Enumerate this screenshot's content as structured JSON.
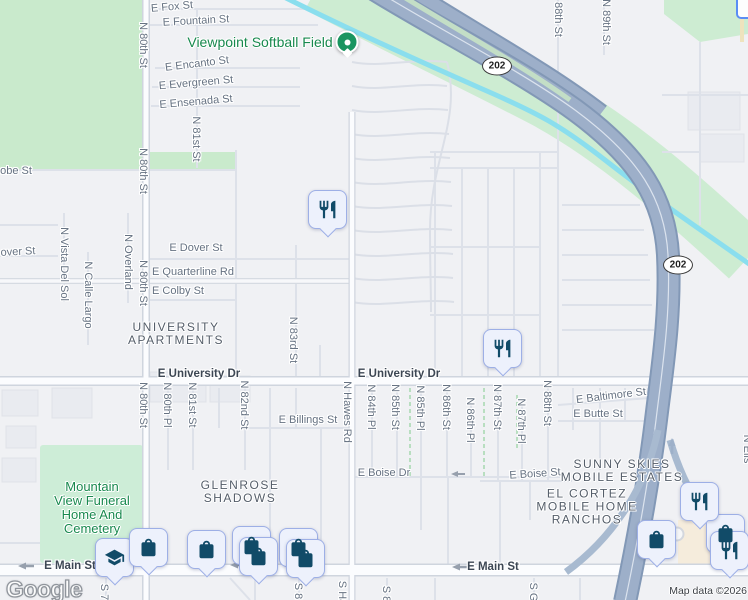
{
  "map": {
    "watermark": "Google",
    "attribution": "Map data ©2026",
    "colors": {
      "background": "#f0f1f4",
      "park_green": "#c9eacc",
      "greenway": "#cdecd2",
      "canal_cyan": "#8adeee",
      "freeway_fill": "#9dafc9",
      "pin_fill": "#edf1fc",
      "pin_border": "#9dafe6",
      "pin_icon": "#114b68",
      "poi_dot_green": "#1a9560",
      "street_label": "#66728a"
    },
    "route_shields": [
      {
        "label": "202",
        "x": 497,
        "y": 66
      },
      {
        "label": "202",
        "x": 678,
        "y": 265
      }
    ],
    "green_marker": {
      "poi": "Viewpoint Softball Field",
      "x": 347,
      "y": 42
    },
    "pins": [
      {
        "icon": "shopping-bag-icon",
        "x": 232,
        "y": 526
      },
      {
        "icon": "shopping-bag-icon",
        "x": 279,
        "y": 528
      },
      {
        "icon": "shopping-bag-icon",
        "x": 706,
        "y": 514
      },
      {
        "icon": "graduation-cap-icon",
        "x": 95,
        "y": 538
      },
      {
        "icon": "shopping-bag-icon",
        "x": 129,
        "y": 528
      },
      {
        "icon": "shopping-bag-icon",
        "x": 187,
        "y": 530
      },
      {
        "icon": "shopping-bag-icon",
        "x": 239,
        "y": 537
      },
      {
        "icon": "shopping-bag-icon",
        "x": 286,
        "y": 539
      },
      {
        "icon": "restaurant-icon",
        "x": 308,
        "y": 190
      },
      {
        "icon": "restaurant-icon",
        "x": 483,
        "y": 329
      },
      {
        "icon": "restaurant-icon",
        "x": 680,
        "y": 482
      },
      {
        "icon": "shopping-bag-icon",
        "x": 637,
        "y": 520
      },
      {
        "icon": "restaurant-icon",
        "x": 710,
        "y": 531
      }
    ],
    "labels": {
      "horizontal": [
        {
          "text": "E Fox St",
          "x": 172,
          "y": 7,
          "rot": -5
        },
        {
          "text": "E Fountain St",
          "x": 196,
          "y": 21,
          "rot": -3
        },
        {
          "text": "E Encanto St",
          "x": 197,
          "y": 64,
          "rot": -7
        },
        {
          "text": "E Evergreen St",
          "x": 196,
          "y": 83,
          "rot": -5
        },
        {
          "text": "E Ensenada St",
          "x": 196,
          "y": 102,
          "rot": -5
        },
        {
          "text": "obe St",
          "x": 16,
          "y": 171,
          "rot": 0
        },
        {
          "text": "over St",
          "x": 18,
          "y": 252,
          "rot": -3
        },
        {
          "text": "E Dover St",
          "x": 196,
          "y": 248,
          "rot": 0
        },
        {
          "text": "E Quarterline Rd",
          "x": 193,
          "y": 272,
          "rot": 0
        },
        {
          "text": "E Colby St",
          "x": 178,
          "y": 291,
          "rot": 0
        },
        {
          "text": "E University Dr",
          "x": 199,
          "y": 374,
          "rot": 0,
          "cls": "primary"
        },
        {
          "text": "E University Dr",
          "x": 399,
          "y": 374,
          "rot": 0,
          "cls": "primary"
        },
        {
          "text": "E Baltimore St",
          "x": 611,
          "y": 396,
          "rot": -7
        },
        {
          "text": "E Butte St",
          "x": 598,
          "y": 414,
          "rot": 0
        },
        {
          "text": "E Billings St",
          "x": 308,
          "y": 420,
          "rot": 0
        },
        {
          "text": "E Boise Dr",
          "x": 384,
          "y": 473,
          "rot": 0
        },
        {
          "text": "E Boise St",
          "x": 535,
          "y": 474,
          "rot": -4
        },
        {
          "text": "E Main St",
          "x": 70,
          "y": 566,
          "rot": 0,
          "cls": "primary"
        },
        {
          "text": "E Main St",
          "x": 493,
          "y": 567,
          "rot": 0,
          "cls": "primary"
        }
      ],
      "vertical": [
        {
          "text": "N 80th St",
          "x": 143,
          "y": 45
        },
        {
          "text": "N 80th St",
          "x": 143,
          "y": 171
        },
        {
          "text": "N 80th St",
          "x": 143,
          "y": 283
        },
        {
          "text": "N 81st St",
          "x": 196,
          "y": 139
        },
        {
          "text": "N Vista Del Sol",
          "x": 64,
          "y": 264
        },
        {
          "text": "N Calle Largo",
          "x": 88,
          "y": 295
        },
        {
          "text": "N Overland",
          "x": 128,
          "y": 262
        },
        {
          "text": "N 83rd St",
          "x": 293,
          "y": 340
        },
        {
          "text": "N 88th St",
          "x": 558,
          "y": 14
        },
        {
          "text": "N 89th St",
          "x": 606,
          "y": 22
        },
        {
          "text": "N 80th St",
          "x": 143,
          "y": 405
        },
        {
          "text": "N 80th Pl",
          "x": 167,
          "y": 405
        },
        {
          "text": "N 81st St",
          "x": 192,
          "y": 405
        },
        {
          "text": "N 82nd St",
          "x": 244,
          "y": 405
        },
        {
          "text": "N Hawes Rd",
          "x": 347,
          "y": 412
        },
        {
          "text": "N 84th Pl",
          "x": 371,
          "y": 407
        },
        {
          "text": "N 85th St",
          "x": 395,
          "y": 407
        },
        {
          "text": "N 85th Pl",
          "x": 420,
          "y": 408
        },
        {
          "text": "N 86th St",
          "x": 446,
          "y": 407
        },
        {
          "text": "N 86th Pl",
          "x": 470,
          "y": 420
        },
        {
          "text": "N 87th St",
          "x": 497,
          "y": 407
        },
        {
          "text": "N 87th Pl",
          "x": 521,
          "y": 421
        },
        {
          "text": "N 88th St",
          "x": 547,
          "y": 403
        },
        {
          "text": "S Haw",
          "x": 342,
          "y": 597
        },
        {
          "text": "S 8",
          "x": 386,
          "y": 594
        },
        {
          "text": "S 7",
          "x": 104,
          "y": 592
        },
        {
          "text": "S 8",
          "x": 298,
          "y": 591
        },
        {
          "text": "S G",
          "x": 533,
          "y": 592
        },
        {
          "text": "N Ells",
          "x": 747,
          "y": 449
        }
      ],
      "areas": [
        {
          "text": "UNIVERSITY\nAPARTMENTS",
          "x": 176,
          "y": 334
        },
        {
          "text": "GLENROSE\nSHADOWS",
          "x": 240,
          "y": 492
        },
        {
          "text": "SUNNY SKIES\nMOBILE ESTATES",
          "x": 622,
          "y": 471
        },
        {
          "text": "EL CORTEZ\nMOBILE HOME\nRANCHOS",
          "x": 587,
          "y": 507
        }
      ],
      "parks": [
        {
          "text": "Viewpoint Softball Field",
          "x": 260,
          "y": 42,
          "size": 14
        },
        {
          "text": "Mountain\nView Funeral\nHome And\nCemetery",
          "x": 92,
          "y": 508,
          "size": 13
        }
      ]
    }
  }
}
